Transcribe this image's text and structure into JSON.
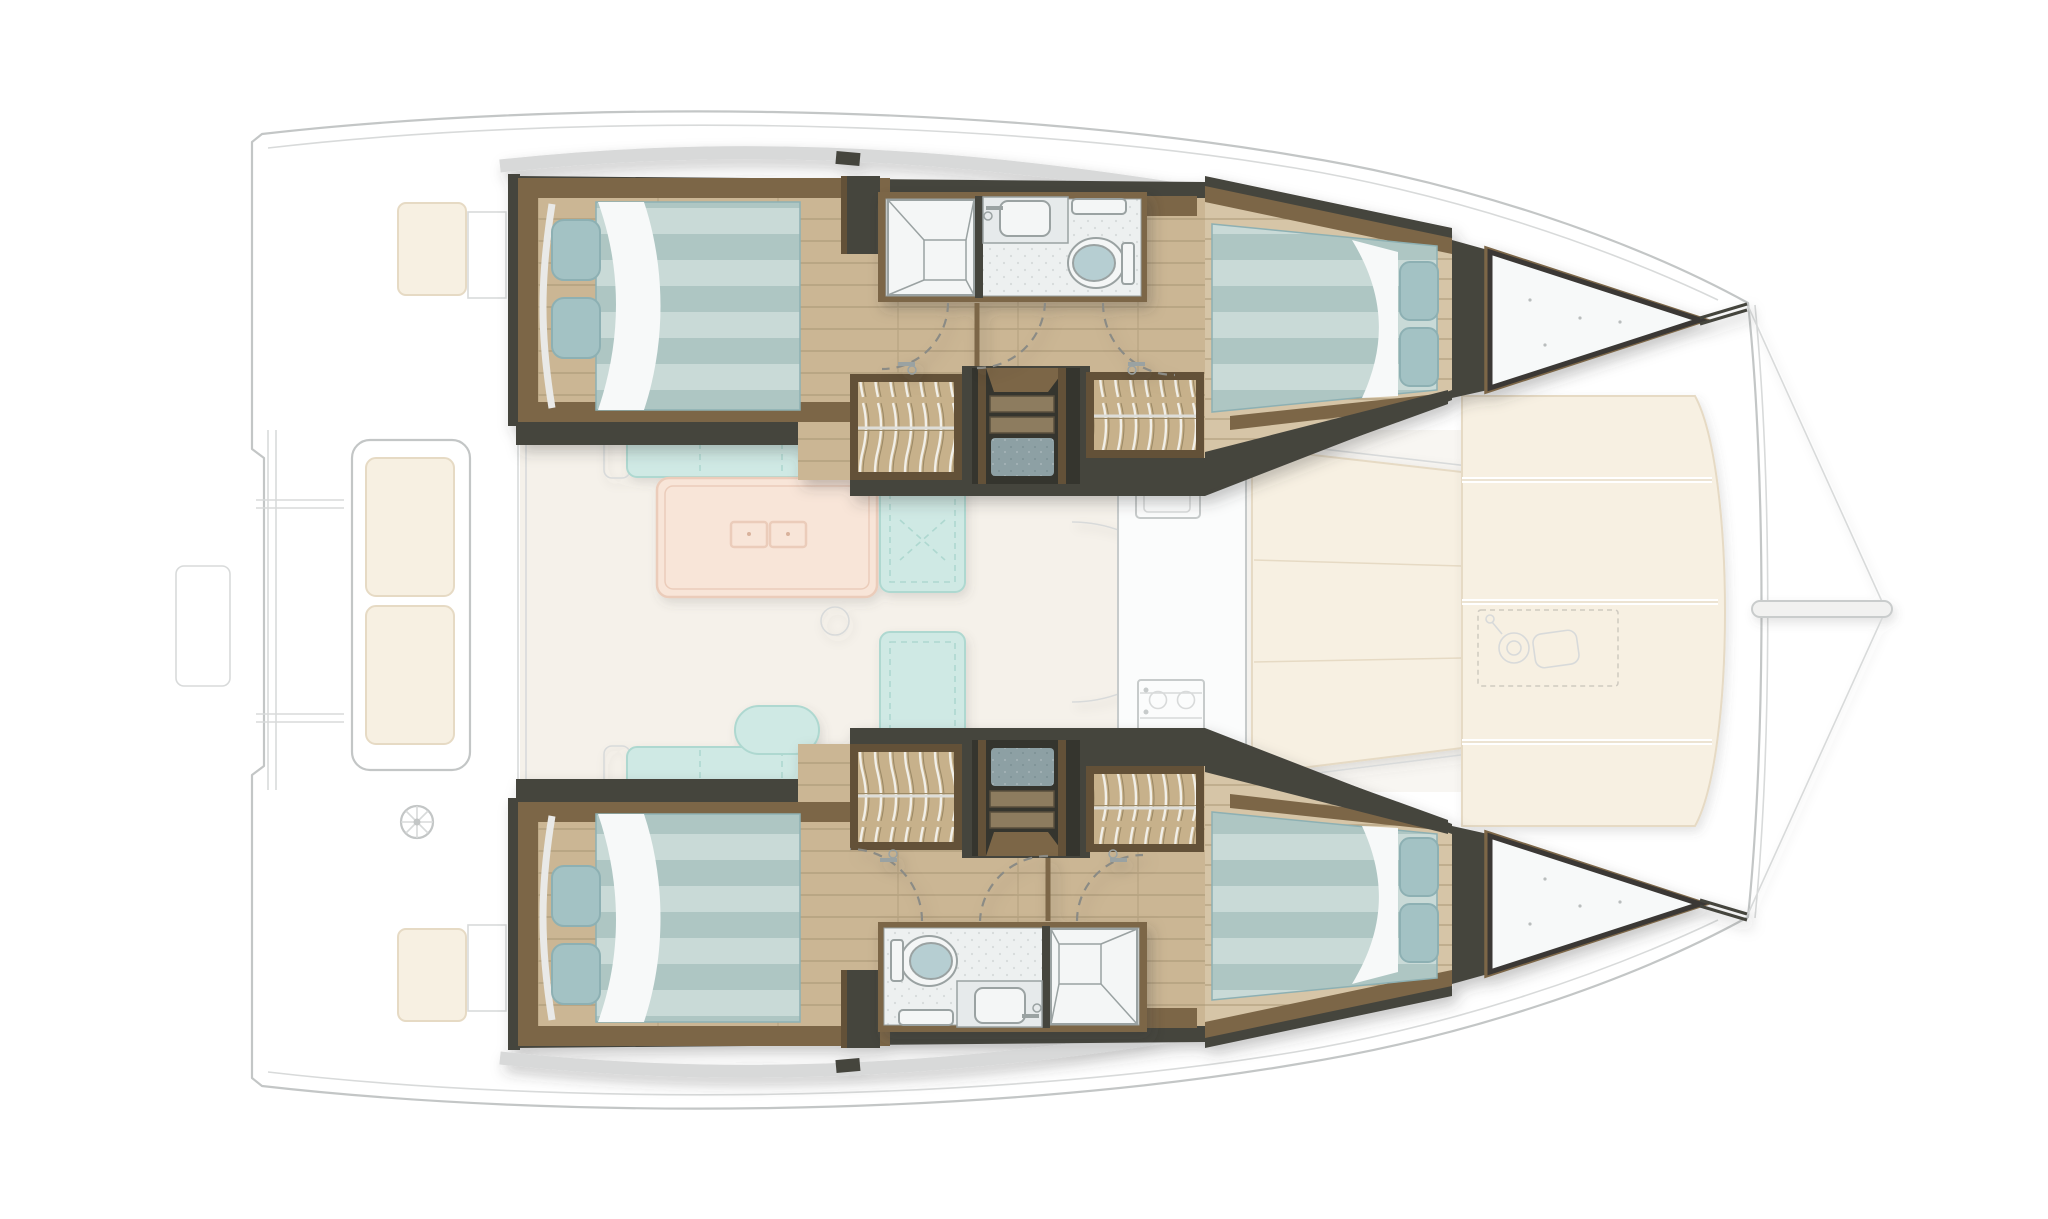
{
  "app": {
    "title": "Sailing catamaran interior layout — top view floor plan"
  },
  "diagram": {
    "type": "floorplan",
    "view": "top-down",
    "vessel": "sailing-catamaran",
    "levels": {
      "hull_level": "highlighted",
      "deck_level": "ghosted"
    },
    "areas": [
      {
        "id": "aft-cockpit",
        "label": "Aft cockpit with bench seating and helm (ghosted)"
      },
      {
        "id": "salon",
        "label": "Salon with L-shaped sofas and folding table (ghosted)"
      },
      {
        "id": "galley",
        "label": "Galley with sink and stove (ghosted)"
      },
      {
        "id": "port-aft-cabin",
        "label": "Port aft double cabin"
      },
      {
        "id": "port-head",
        "label": "Port head: shower, sink, toilet"
      },
      {
        "id": "port-lockers",
        "label": "Port hanging lockers"
      },
      {
        "id": "port-companionway",
        "label": "Port companionway stairs"
      },
      {
        "id": "port-fwd-cabin",
        "label": "Port forward double cabin"
      },
      {
        "id": "port-forepeak",
        "label": "Port forepeak locker"
      },
      {
        "id": "stbd-aft-cabin",
        "label": "Starboard aft double cabin"
      },
      {
        "id": "stbd-head",
        "label": "Starboard head: toilet, sink, shower"
      },
      {
        "id": "stbd-lockers",
        "label": "Starboard hanging lockers"
      },
      {
        "id": "stbd-companionway",
        "label": "Starboard companionway stairs"
      },
      {
        "id": "stbd-fwd-cabin",
        "label": "Starboard forward double cabin"
      },
      {
        "id": "stbd-forepeak",
        "label": "Starboard forepeak locker"
      },
      {
        "id": "fwd-cockpit",
        "label": "Forward cockpit lounge (ghosted)"
      },
      {
        "id": "foredeck",
        "label": "Foredeck sunpads with windlass (ghosted)"
      },
      {
        "id": "bowsprit",
        "label": "Bowsprit with bridle lines"
      }
    ],
    "icons": [
      "steering-wheel-icon",
      "winch-icon",
      "faucet-icon",
      "sink-icon",
      "stove-icon",
      "toilet-icon",
      "shower-icon",
      "door-swing-arc",
      "hanging-rail-icon",
      "stairs-icon",
      "door-handle-icon"
    ],
    "colors": {
      "background": "#ffffff",
      "ghost_line": "#c3c6c6",
      "ghost_line_light": "#d8dada",
      "deck_band_grey": "#d8d9d9",
      "salon_floor": "#f5f1ea",
      "cockpit_floor": "#f8f6f2",
      "cream_pad": "#f7f0e2",
      "cream_pad_edge": "#e6dac4",
      "seam_white": "#ffffff",
      "sofa_teal": "#cfe9e4",
      "sofa_teal_edge": "#aed8d0",
      "table_peach": "#f8e5d8",
      "table_peach_edge": "#ebccba",
      "galley_white": "#fbfcfc",
      "galley_edge": "#c7cbcb",
      "hull_charcoal": "#45443e",
      "stair_pit": "#35342e",
      "wood_trim": "#7c6647",
      "wood_trim_dark": "#645139",
      "floor_wood": "#cbb694",
      "floor_wood_line": "#b3a07e",
      "floor_wood_fwd": "#d6c5a7",
      "locker_wood": "#c7b18b",
      "locker_wave": "#f1efe8",
      "locker_wave_dark": "#9c8a66",
      "mattress_a": "#c9dad7",
      "mattress_b": "#aec6c3",
      "pillow": "#a3c2c4",
      "pillow_edge": "#8db0b3",
      "sheet_white": "#f7f9f9",
      "bath_floor": "#edf0f0",
      "bath_speck": "#d6dada",
      "bath_fixture": "#f4f6f6",
      "bath_fixture_edge": "#9aa2a2",
      "counter_grey": "#e6eaeb",
      "toilet_lid": "#b6ced2",
      "stair_mat": "#8da0a4",
      "stair_mat_dark": "#7c9094",
      "tread_wood": "#8d7c5f",
      "tread_edge": "#594f3c",
      "arc_dash": "#8b8b85",
      "metal_grey": "#b9bdbd"
    }
  }
}
